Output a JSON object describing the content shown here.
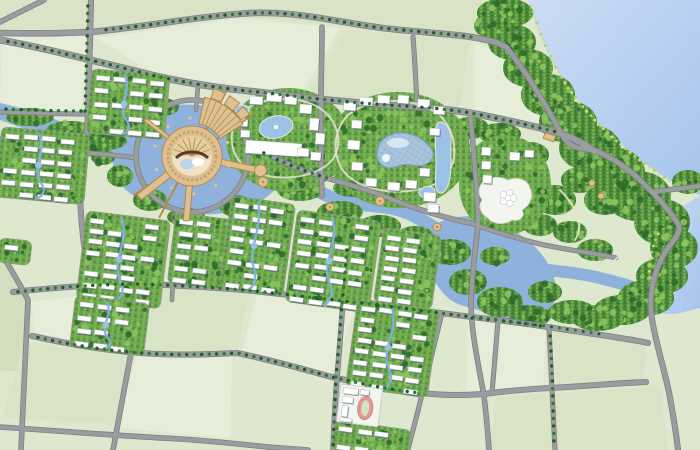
{
  "meta": {
    "kind": "master-plan-site-map",
    "viewport": {
      "width": 700,
      "height": 450
    }
  },
  "features": {
    "lake": "large lake in upper right corner",
    "shore_forest": "dense tree belt curving along the lakeshore",
    "river": "blue river corridor winding west-to-east through the center, widening into a mid lake",
    "central_plaza": "circular tan landmark plaza on an island with radiating piers and fan-shaped jetties",
    "glass_roof_hall": "kidney-shaped blue glass-roof building in the east campus cluster",
    "west_campus": "public-building cluster with oval pond and long white hall",
    "resort_cluster": "white resort buildings with round pond beside the lake bay",
    "school": "school campus with pink running track in the lower center",
    "residential_block_count": 11,
    "road_network": "slightly rotated arterial grid lined with street trees",
    "fields": "pale green agricultural parcels filling the outer areas"
  },
  "colors": {
    "field_base": "#dee8cf",
    "field_light": "#e6eeda",
    "field_mid": "#d9e4c6",
    "field_dark": "#d2dfbf",
    "road_fill": "#9a9d9f",
    "road_edge": "#7d8082",
    "lake_light": "#cbdcf6",
    "lake_dark": "#a6c4ec",
    "river": "#8fb2dc",
    "pond": "#9cc2e6",
    "pond_edge": "#e9e6d8",
    "stream": "#7fb0e0",
    "woods_base": "#55923f",
    "woods_dark": "#2f6b2c",
    "woods_light": "#8cc45e",
    "shore_dot": "#cfe37a",
    "block_green": "#6ca74e",
    "building_white": "#ffffff",
    "building_shadow": "#5d6a70",
    "building_stroke": "#aeb6ba",
    "street_tree": "#1e5c28",
    "street_tree_alt": "#2f7a33",
    "plaza_tan": "#dfc191",
    "plaza_tan_dark": "#b28b52",
    "plaza_cream": "#f0e2c4",
    "plaza_ring": "#c9a36b",
    "swirl_brown": "#5a3c28",
    "glass_roof": "#a9c5dd",
    "glass_grid": "#7e9fbd",
    "glass_highlight": "#ddecf5",
    "track_pink": "#e49a92",
    "track_edge": "#c98880",
    "track_infield": "#cfe0c4",
    "campus_ground": "#f3f5ef",
    "ground_stroke": "#c9cfc4",
    "loop_path": "#e9e3d2"
  }
}
